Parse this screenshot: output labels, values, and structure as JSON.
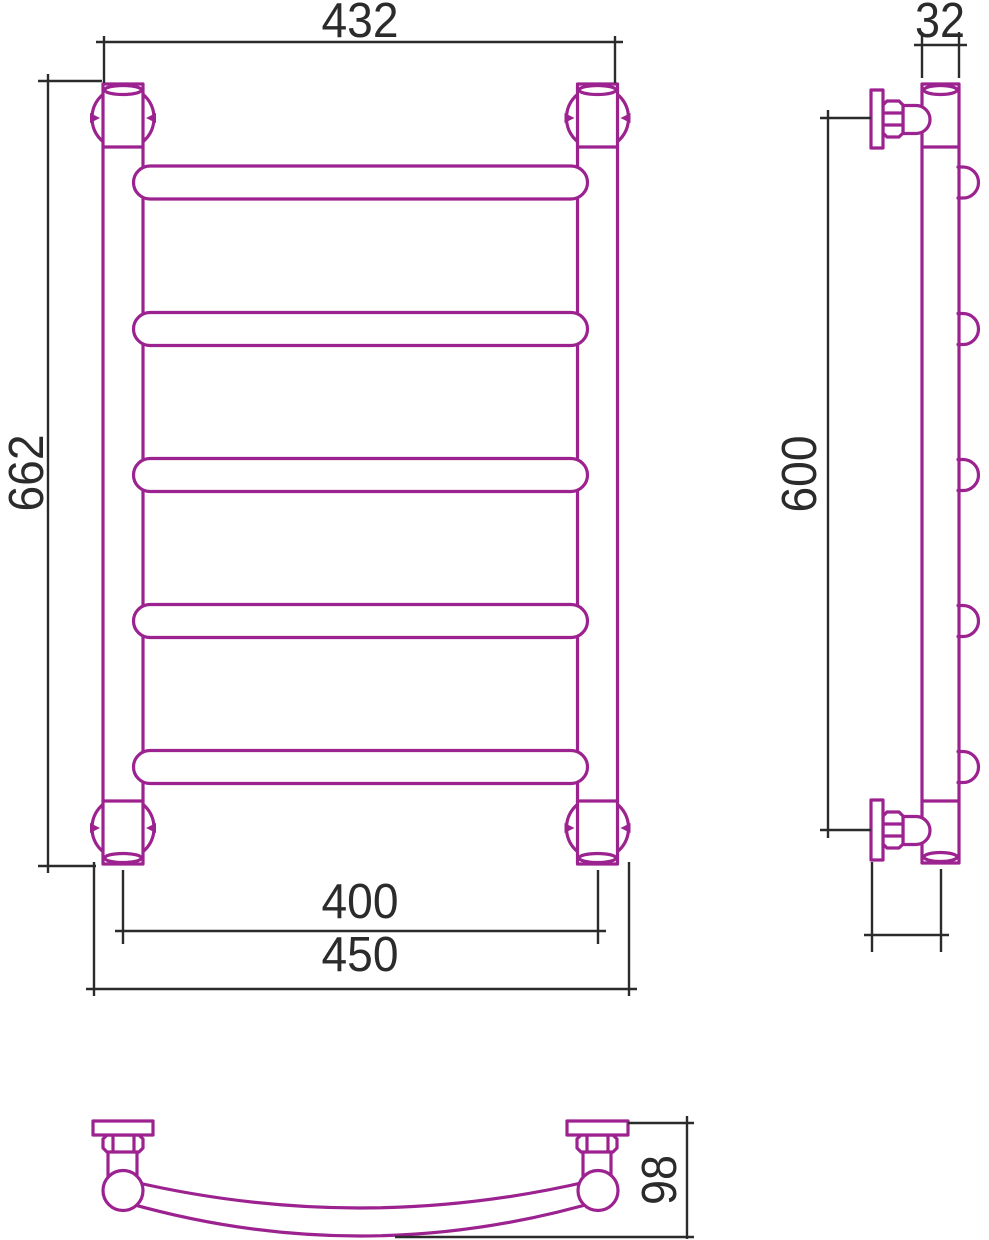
{
  "document": {
    "type": "technical-drawing",
    "subject": "ladder towel rail, three orthographic views with dimensions"
  },
  "colors": {
    "product_outline": "#9C2290",
    "dimension_lines": "#2B2B2B",
    "background": "#FFFFFF"
  },
  "views": {
    "front": {
      "rung_count": 5,
      "wall_mount_count": 4,
      "dims": {
        "outer_post_width": "432",
        "overall_height": "662",
        "post_center_width": "400",
        "overall_width": "450"
      }
    },
    "side": {
      "rung_bump_count": 5,
      "bracket_count": 2,
      "dims": {
        "tube_diameter": "32",
        "bracket_span": "600",
        "wall_to_axis": "60"
      }
    },
    "bottom": {
      "dims": {
        "depth": "98"
      }
    }
  }
}
